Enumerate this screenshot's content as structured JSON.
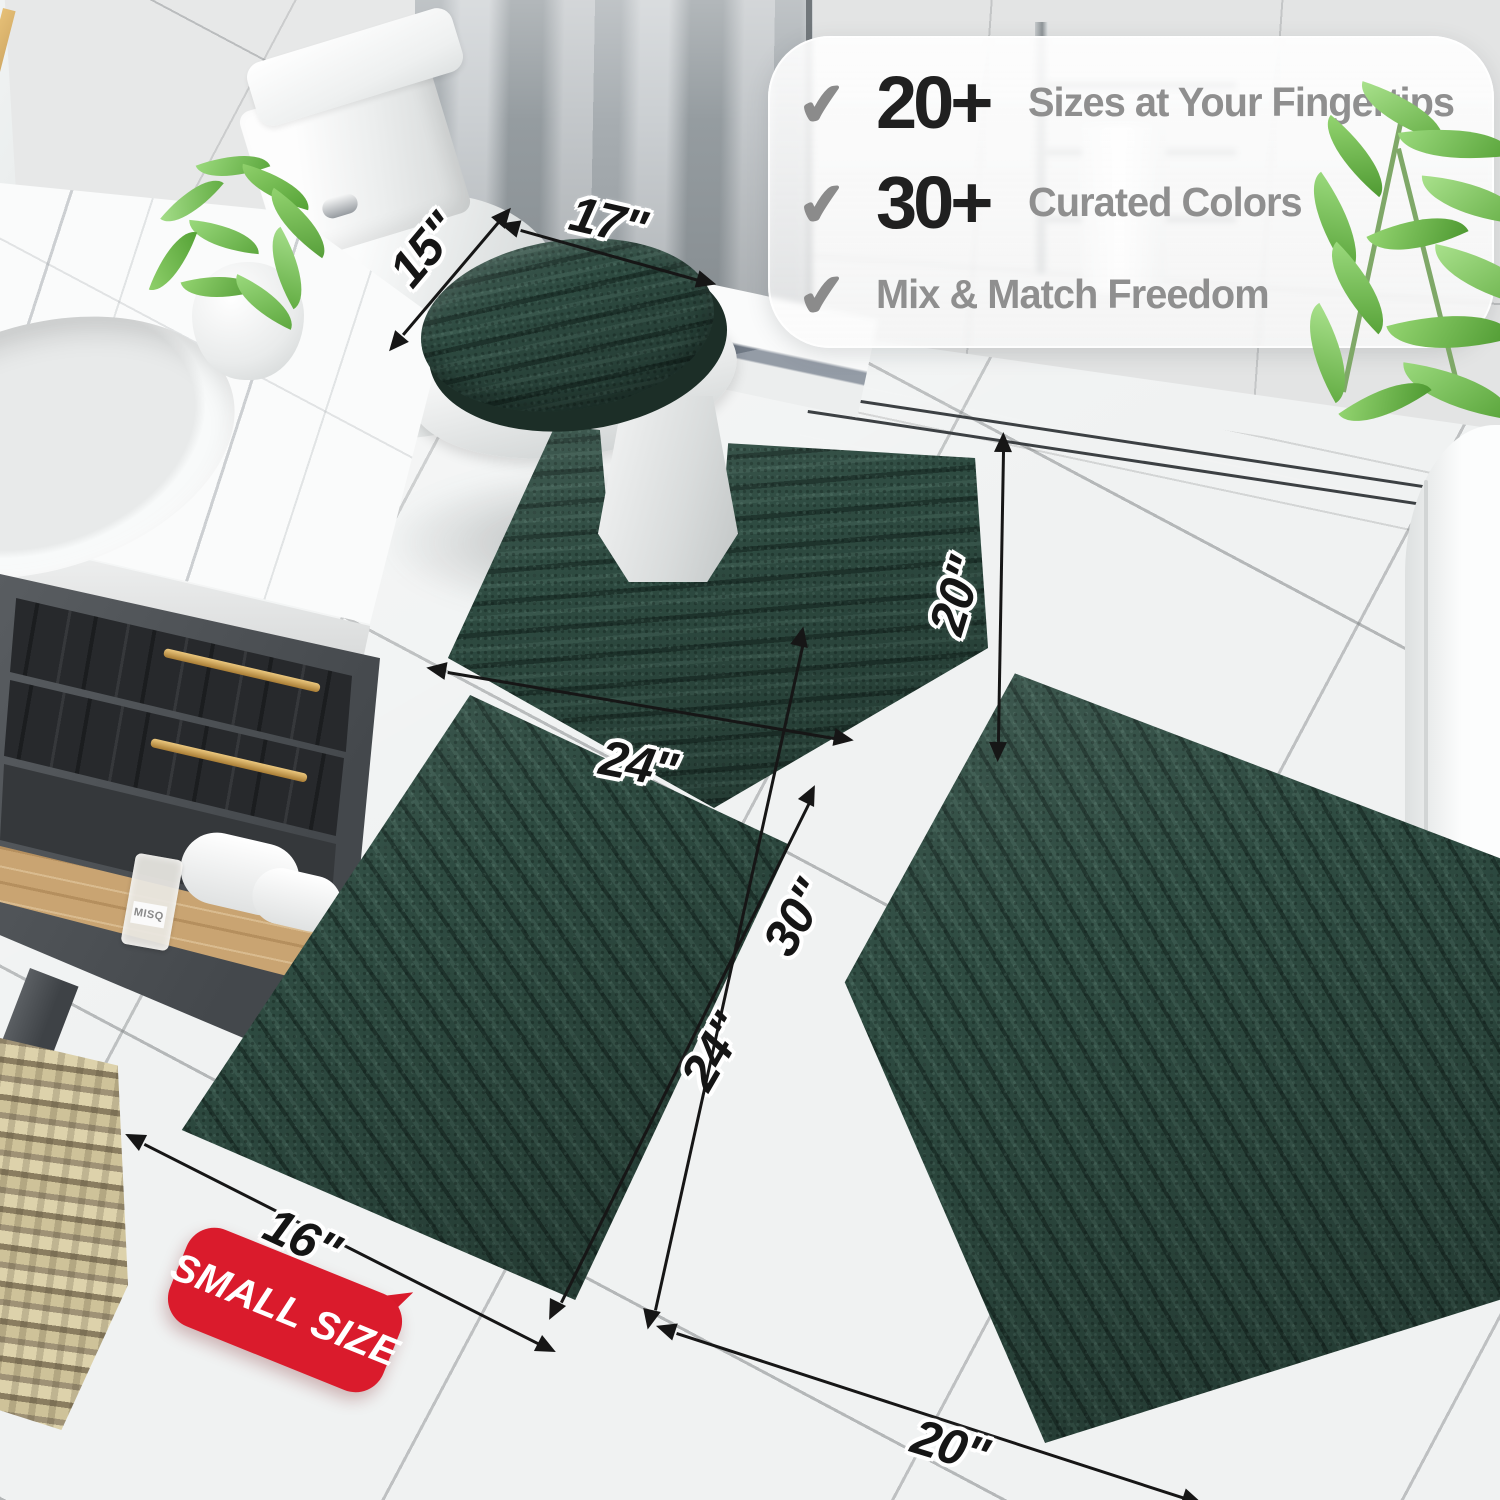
{
  "page": {
    "type": "product-photo",
    "subject": "3-piece dark green chenille bathroom rug set shown in a bathroom"
  },
  "callout": {
    "check_glyph": "✔",
    "items": [
      {
        "icon": "check",
        "number": "20+",
        "label": "Sizes at Your Fingertips"
      },
      {
        "icon": "check",
        "number": "30+",
        "label": "Curated Colors"
      },
      {
        "icon": "check",
        "number": "",
        "label": "Mix & Match Freedom"
      }
    ]
  },
  "dimensions": {
    "lid_cover_width": "15\"",
    "lid_cover_length": "17\"",
    "contour_rug_depth": "20\"",
    "contour_rug_width": "24\"",
    "small_rug_length": "24\"",
    "small_rug_width": "16\"",
    "large_rug_length": "30\"",
    "large_rug_width": "20\""
  },
  "badge": {
    "label": "SMALL SIZE"
  },
  "perfume_bottle": {
    "label": "MISQ"
  },
  "accents": {
    "rug_color": "#2f4c42",
    "badge_color": "#da1b2c",
    "callout_number_color": "#202020",
    "callout_text_color": "#8f8f8f",
    "check_color": "#8b8b8b"
  }
}
